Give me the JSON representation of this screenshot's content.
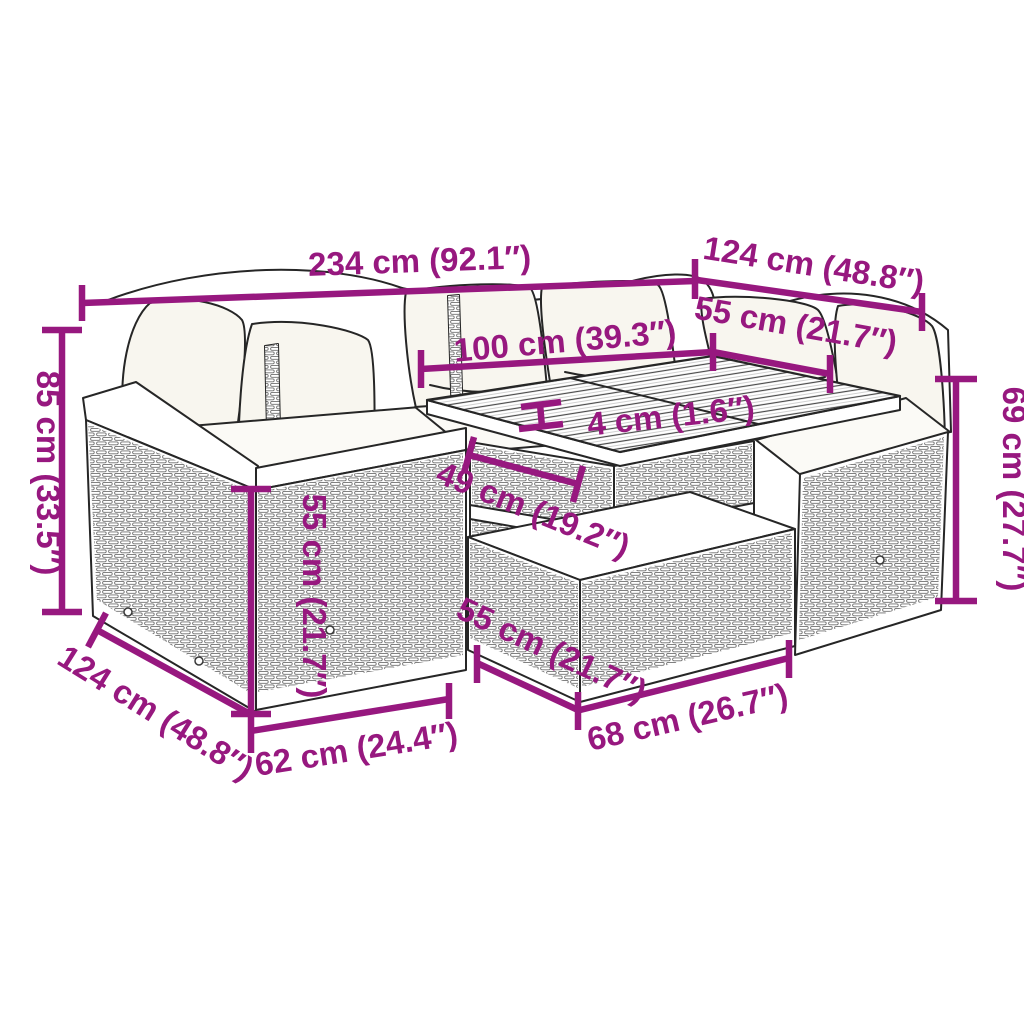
{
  "illustration": {
    "subject": "rattan-garden-lounge-set-with-table",
    "style": "black line art with woven texture, white cushions"
  },
  "colors": {
    "dimension": "#97187F",
    "line_art": "#262626",
    "background": "#FFFFFF"
  },
  "dimensions": {
    "d234": {
      "label": "234 cm (92.1″)"
    },
    "d124t": {
      "label": "124 cm (48.8″)"
    },
    "d55t": {
      "label": "55 cm (21.7″)"
    },
    "d100": {
      "label": "100 cm (39.3″)"
    },
    "d4": {
      "label": "4 cm (1.6″)"
    },
    "d49": {
      "label": "49 cm (19.2″)"
    },
    "d85": {
      "label": "85 cm (33.5″)"
    },
    "d55m": {
      "label": "55 cm (21.7″)"
    },
    "d124b": {
      "label": "124 cm (48.8″)"
    },
    "d62": {
      "label": "62 cm (24.4″)"
    },
    "d55b": {
      "label": "55 cm (21.7″)"
    },
    "d68": {
      "label": "68 cm (26.7″)"
    },
    "d69": {
      "label": "69 cm (27.7″)"
    }
  }
}
